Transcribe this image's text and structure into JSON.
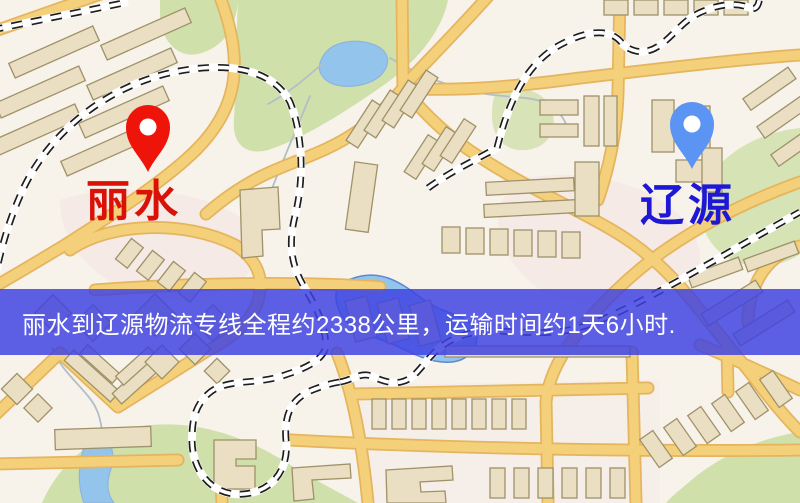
{
  "map": {
    "origin": {
      "name": "丽水",
      "marker_color": "#ee1409",
      "label_color": "#da1106"
    },
    "destination": {
      "name": "辽源",
      "marker_color": "#5b94f2",
      "label_color": "#1e17d6"
    },
    "banner": {
      "text": "丽水到辽源物流专线全程约2338公里，运输时间约1天6小时.",
      "distance": "约2338公里",
      "duration": "约1天6小时",
      "background_color": "#3e42e1",
      "text_color": "#ffffff"
    },
    "colors": {
      "background": "#f7f2ea",
      "road": "#f5d07a",
      "road_border": "#e4b55e",
      "building": "#eadfc2",
      "park": "#cfe0ab",
      "water": "#93c5ec",
      "railway": "#1d1d1d",
      "railway_bed": "#ffffff"
    }
  }
}
